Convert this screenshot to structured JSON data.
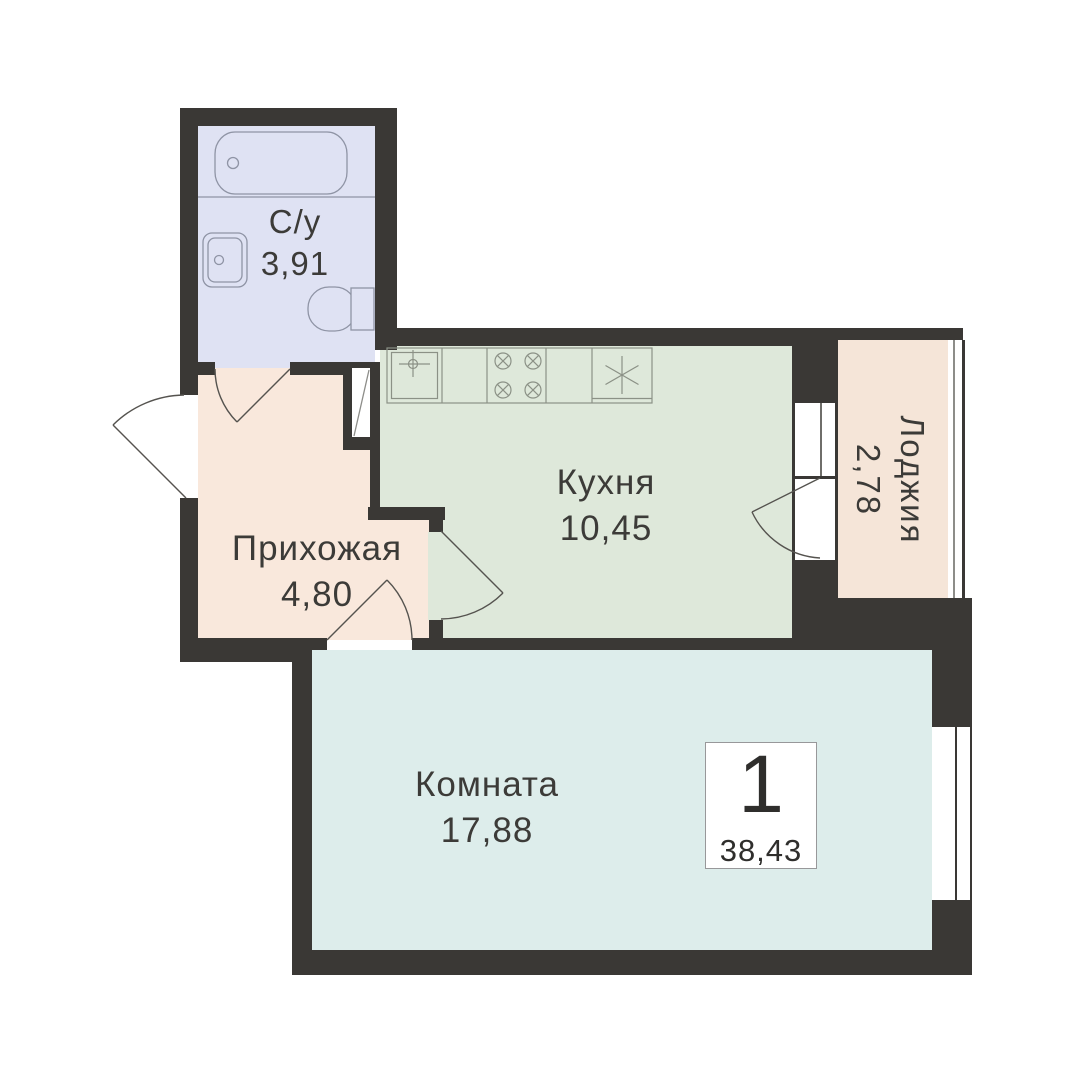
{
  "floorplan": {
    "type": "apartment-floor-plan",
    "badge": {
      "rooms_count": "1",
      "total_area": "38,43"
    },
    "rooms": [
      {
        "key": "bathroom",
        "label": "С/у",
        "area": "3,91"
      },
      {
        "key": "hallway",
        "label": "Прихожая",
        "area": "4,80"
      },
      {
        "key": "kitchen",
        "label": "Кухня",
        "area": "10,45"
      },
      {
        "key": "loggia",
        "label": "Лоджия",
        "area": "2,78"
      },
      {
        "key": "room",
        "label": "Комната",
        "area": "17,88"
      }
    ],
    "colors": {
      "background": "#ffffff",
      "walls": "#3a3835",
      "bathroom_fill": "#dfe2f3",
      "hallway_fill": "#f9e8dc",
      "kitchen_fill": "#dee8da",
      "loggia_fill": "#f5e5d8",
      "room_fill": "#ddedeb",
      "fixture_line": "#8f94a5",
      "counter_line": "#8b9186",
      "door_arc_line": "#55534f"
    },
    "icons": {
      "bathtub": "rounded-rect-with-overflow-circle",
      "washbasin": "double-rounded-rect-with-circle",
      "toilet": "stadium-bowl-with-tank",
      "kitchen_sink": "square-with-crosshair-circle",
      "stove": "four-crossed-burner-circles",
      "appliance": "square-with-asterisk",
      "vent_shaft": "rect-with-diagonal",
      "window": "white-band-with-glazing-line",
      "door": "quarter-arc-swing"
    }
  }
}
